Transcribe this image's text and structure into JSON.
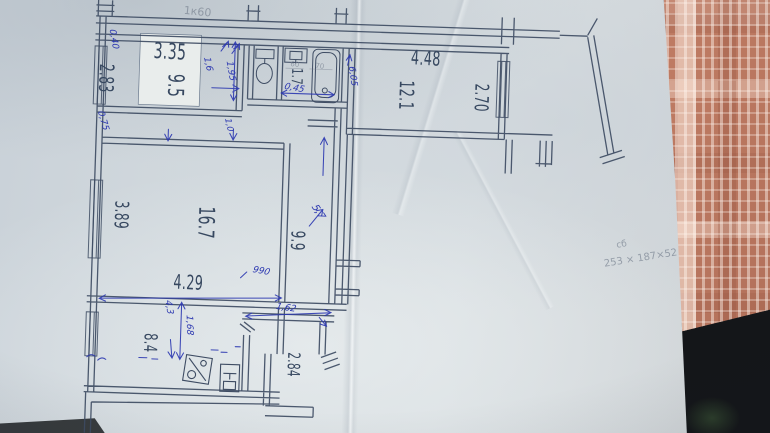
{
  "plan": {
    "rooms": {
      "bedroom": {
        "width": "3.35",
        "area": "9.5",
        "depth": "2.83"
      },
      "bathroom": {
        "area": "1.7"
      },
      "upper_room": {
        "width": "4.48",
        "area": "12.1",
        "depth": "2.70"
      },
      "living_room": {
        "area": "16.7",
        "depth": "3.89",
        "width": "4.29"
      },
      "hallway": {
        "area": "9.9"
      },
      "kitchen": {
        "area": "8.4"
      },
      "entry_corridor": {
        "depth": "2.84"
      }
    },
    "blue_pen_notes": {
      "n040": "0,40",
      "n075": "0,75",
      "n16": "1,6",
      "n195": "1,95",
      "n10": "1,0",
      "n045": "0,45",
      "n605": "6,05",
      "n57": "5,7",
      "n990": "990",
      "n43": "4,3",
      "n168": "1,68",
      "n162": "1,62"
    },
    "pencil_notes": {
      "top": "1к60",
      "sink": "60",
      "tub": "70",
      "margin_label": "сб",
      "margin_calc": "253 × 187×52"
    },
    "icons": {
      "toilet": "toilet-icon",
      "washbasin": "washbasin-icon",
      "bathtub": "bathtub-icon",
      "kitchen_sink": "kitchen-sink-icon",
      "stove": "stove-icon",
      "window": "window-hatch",
      "balcony": "balcony-rail"
    },
    "colors": {
      "ink": "#3e4c63",
      "blue_pen": "#2a36b0",
      "pencil": "#7c8694",
      "paper": "#d4dbdf",
      "tablecloth": "#c4846c",
      "table_dark": "#141619"
    }
  }
}
